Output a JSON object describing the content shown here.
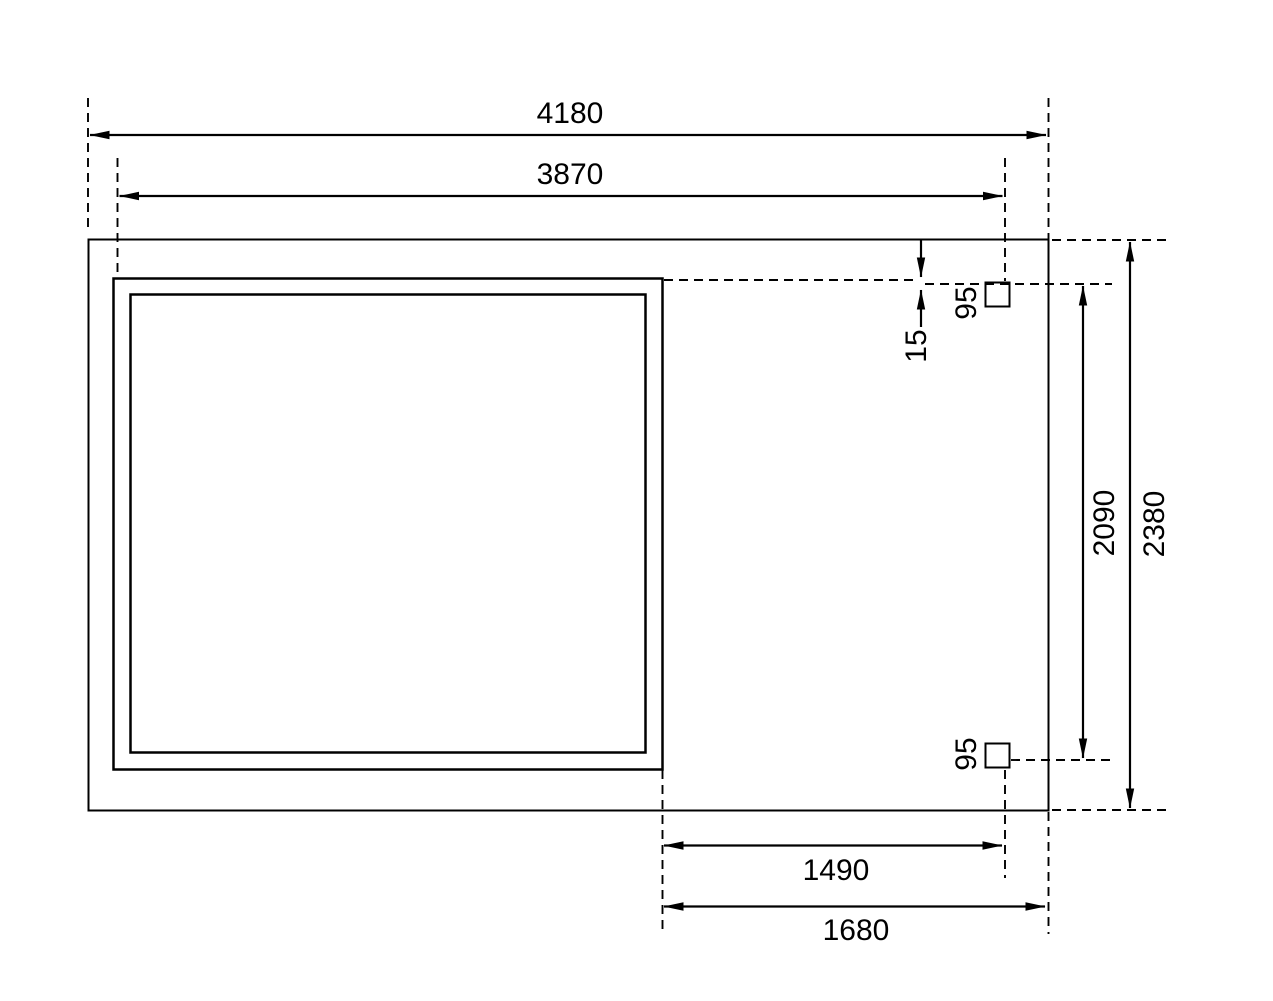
{
  "diagram": {
    "type": "dimensioned-floor-plan",
    "description": "Top view floor plan of a shed with side annex roof and two support posts, all dimensions in mm",
    "labels": {
      "total_width": "4180",
      "house_width": "3870",
      "gap_offset": "15",
      "post_size_top": "95",
      "post_size_bottom": "95",
      "post_span_depth": "2090",
      "total_depth": "2380",
      "annex_inner_width": "1490",
      "annex_outer_width": "1680"
    },
    "colors": {
      "background": "#ffffff",
      "slab_fill": "#f0f0f0",
      "interior_fill": "#f2f2f2",
      "wall_fill": "#9e9e9e",
      "post_fill": "#a2a2a2",
      "line_color": "#000000"
    }
  }
}
